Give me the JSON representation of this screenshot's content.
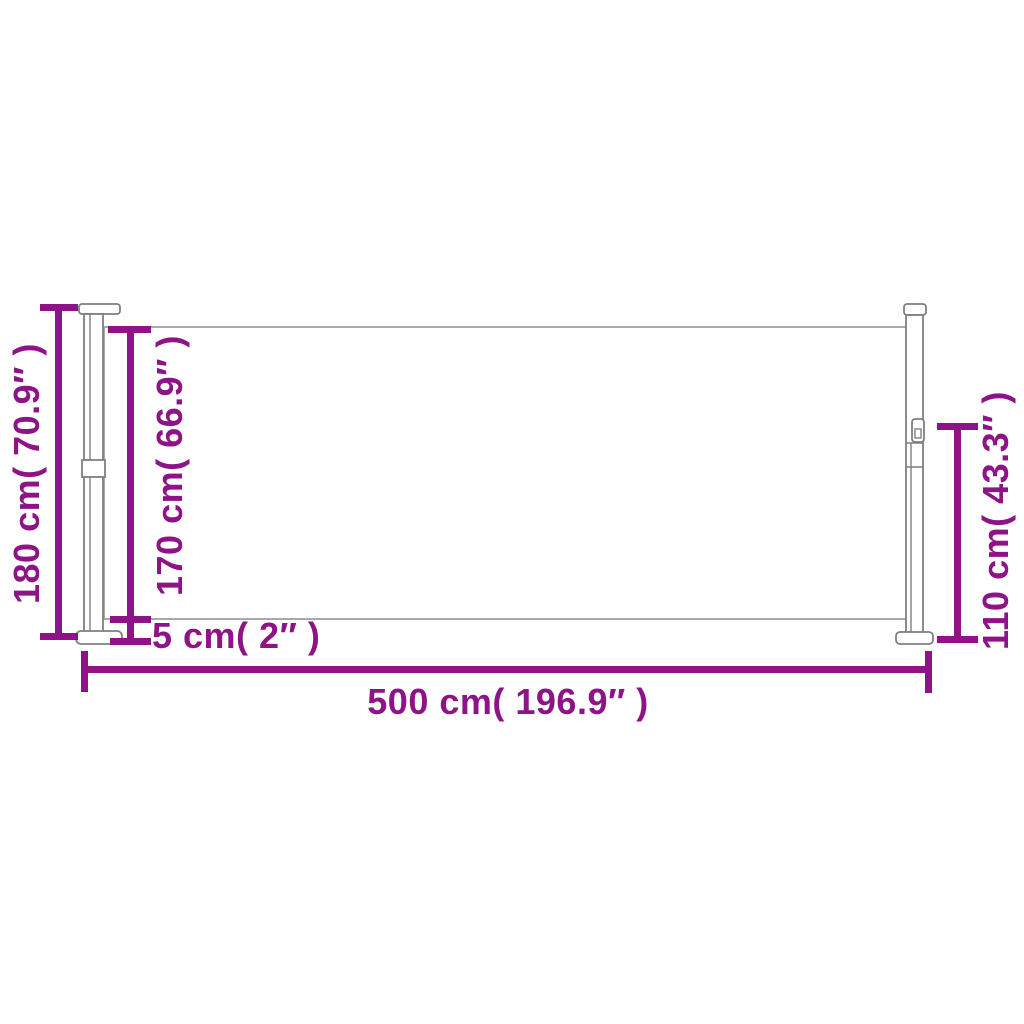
{
  "colors": {
    "dimension": "#8d1387",
    "outline": "#7f7f7f",
    "panel_edge": "#a9a9a9",
    "panel_fill": "#ffffff",
    "background": "#ffffff"
  },
  "labels": {
    "total_height": "180 cm( 70.9″ )",
    "screen_height": "170 cm( 66.9″ )",
    "bottom_gap": "5 cm( 2″ )",
    "total_width": "500 cm( 196.9″ )",
    "right_height": "110 cm( 43.3″ )"
  }
}
